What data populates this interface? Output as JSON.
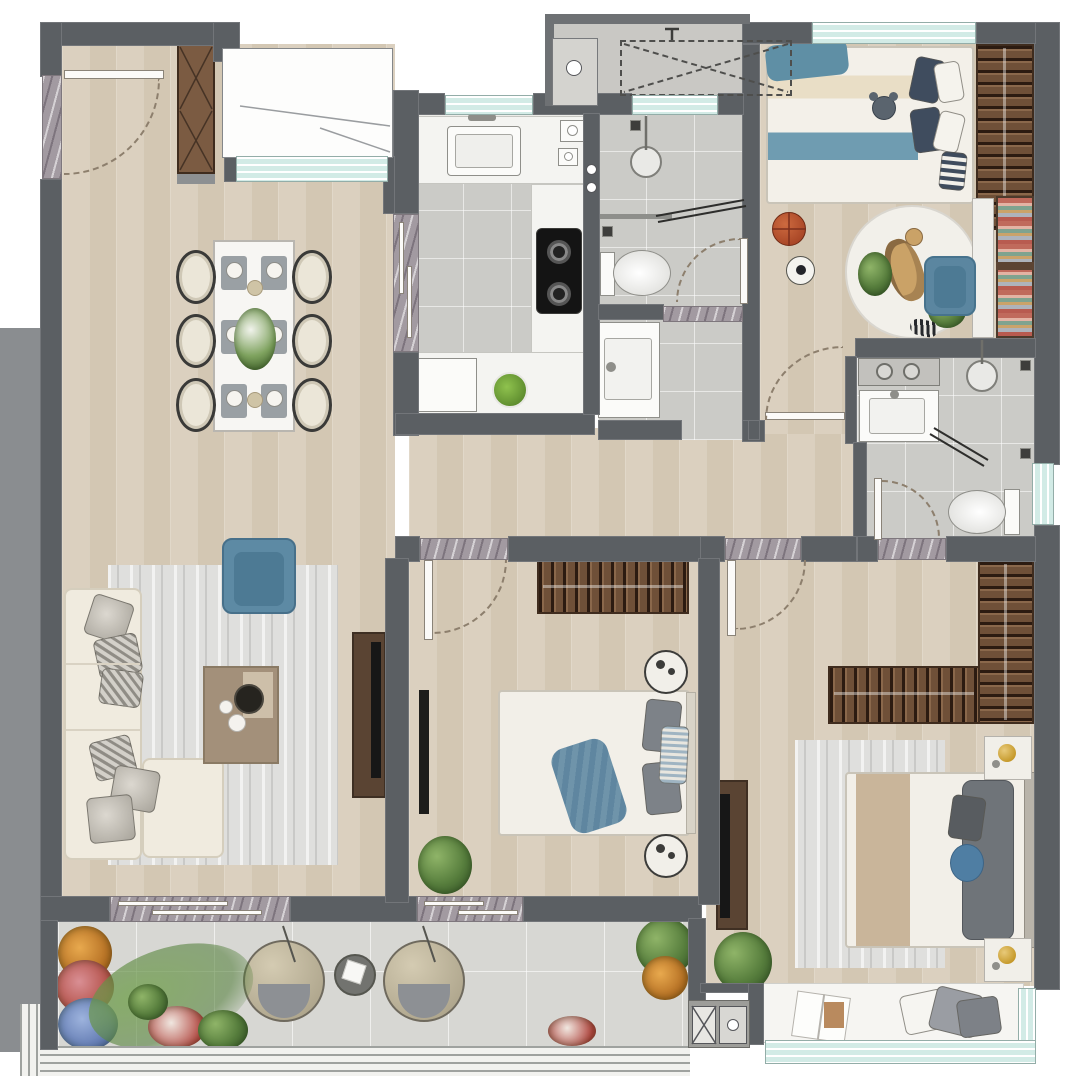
{
  "meta": {
    "type": "apartment-floor-plan",
    "style": "rendered color top-down architectural plan",
    "canvas": {
      "width": 1080,
      "height": 1084
    },
    "text_visible": "none"
  },
  "palette": {
    "wall": "#5b5f63",
    "wood_floor": "#d8cdbb",
    "bath_tile": "#cbcbc7",
    "balcony_tile": "#d7d7d3",
    "window_glass": "#d2ebe6",
    "marble_threshold": "#a29aa1",
    "wood_furniture": "#6f5038",
    "accent_blue": "#5d8aa4",
    "cream_sofa": "#f0ebdf",
    "tv_black": "#171717",
    "plant_green": "#577e3d",
    "gold_decor": "#c9a24b",
    "basketball_orange": "#b54a2c",
    "rug_gray": "#dfdfdd"
  },
  "rooms": [
    {
      "id": "entry",
      "name": "Entry Foyer",
      "features": [
        "entry-door-swing",
        "shoe-cabinet-x-pattern",
        "marble-threshold"
      ]
    },
    {
      "id": "dining",
      "name": "Dining Area",
      "features": [
        "marble-dining-table",
        "six-upholstered-chairs",
        "place-settings",
        "flower-centerpiece",
        "bay-window"
      ]
    },
    {
      "id": "kitchen",
      "name": "Kitchen",
      "features": [
        "double-basin-sink",
        "two-burner-gas-cooktop",
        "l-shaped-counter",
        "refrigerator",
        "vegetable-plate",
        "sliding-door-threshold",
        "window"
      ]
    },
    {
      "id": "platform",
      "name": "Equipment Platform",
      "features": [
        "ac-outdoor-unit-dashed",
        "water-tap",
        "duct-shaft-with-pipe"
      ]
    },
    {
      "id": "bathroom_shared",
      "name": "Shared Bathroom",
      "features": [
        "shower-with-glass-screen",
        "shower-head",
        "toilet",
        "vanity-washbasin",
        "floor-drains",
        "door-swing",
        "window"
      ]
    },
    {
      "id": "kids_bedroom",
      "name": "Kids Bedroom",
      "features": [
        "striped-single-bed",
        "teddy-bear",
        "navy-pillows",
        "slatted-wardrobe",
        "desk",
        "blue-chair",
        "color-bookshelf",
        "giraffe-round-rug",
        "basketball",
        "soccer-ball",
        "door-swing",
        "window"
      ]
    },
    {
      "id": "master_bathroom",
      "name": "Master Bathroom",
      "features": [
        "laundry-counter-two-hobs",
        "vanity-washbasin",
        "corner-shower-glass",
        "shower-head",
        "toilet",
        "floor-drains",
        "door-swing",
        "window"
      ]
    },
    {
      "id": "living",
      "name": "Living Room",
      "features": [
        "l-shaped-cream-sofa",
        "striped-cushions",
        "blue-armchair",
        "wood-coffee-table",
        "gray-area-rug",
        "tv-console",
        "wall-tv",
        "sliding-door-to-balcony"
      ]
    },
    {
      "id": "hallway",
      "name": "Hallway",
      "features": [
        "wood-floor",
        "marble-door-thresholds"
      ]
    },
    {
      "id": "bedroom2",
      "name": "Second Bedroom",
      "features": [
        "double-bed",
        "blue-throw-blanket",
        "gray-pillows",
        "slatted-wardrobe",
        "round-nightstands",
        "wall-tv",
        "potted-plant",
        "door-swing",
        "sliding-door-to-balcony"
      ]
    },
    {
      "id": "master_bedroom",
      "name": "Master Bedroom",
      "features": [
        "double-bed-tan-runner",
        "blue-round-cushion",
        "l-shaped-slatted-wardrobe",
        "nightstands-gold-decor",
        "tv-console",
        "gray-rug",
        "potted-plant",
        "door-swing",
        "bay-window-seat-with-book-and-pillows"
      ]
    },
    {
      "id": "balcony",
      "name": "Balcony",
      "features": [
        "two-rattan-hanging-egg-chairs",
        "round-side-table-with-book",
        "flower-garden-orange-red-blue",
        "palm-plants",
        "tile-floor",
        "railing"
      ]
    }
  ]
}
